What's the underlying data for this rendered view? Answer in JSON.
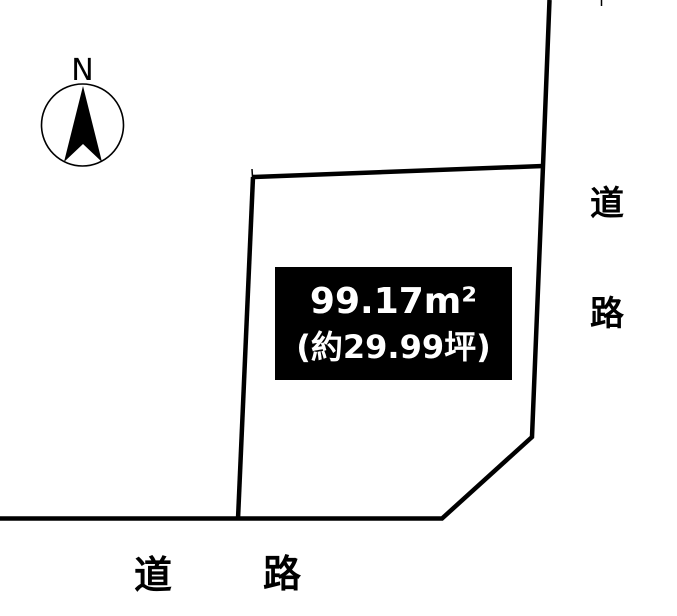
{
  "colors": {
    "background": "#ffffff",
    "line": "#000000",
    "area_box_bg": "#000000",
    "area_box_text": "#ffffff"
  },
  "compass": {
    "north_label": "N"
  },
  "area_label": {
    "line1": "99.17m²",
    "line2": "(約29.99坪)"
  },
  "road_labels": {
    "right": {
      "char1": "道",
      "char2": "路"
    },
    "bottom": {
      "char1": "道",
      "char2": "路"
    }
  }
}
